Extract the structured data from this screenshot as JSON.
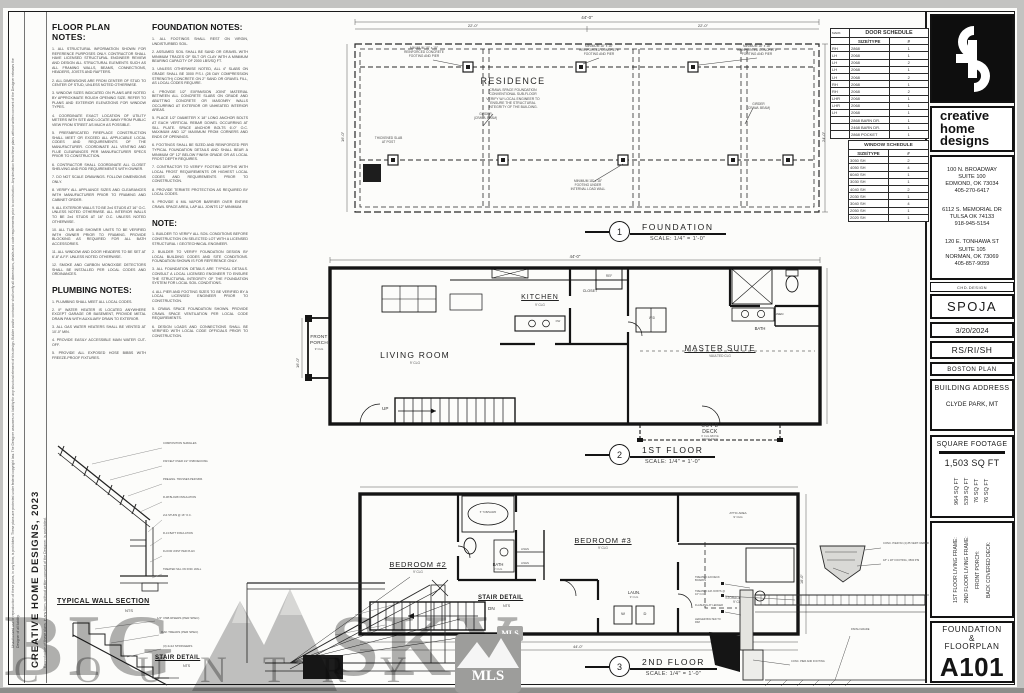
{
  "sheet": {
    "margin_disclaimer": "Unauthorized use or reproduction of these plans, in any form, is prohibited. These plans are protected under federal copyright law. The Designer assumes no liability for any structural element of this design. Builder and/or contractor shall verify all dimensions, details and code requirements prior to construction. Any deviation from these plans without written consent of the Designer releases the Designer of all liability.",
    "side_firm_line": "CREATIVE HOME DESIGNS, 2023",
    "side_sub_line": "Reproduction of these plans, in any form, without written consent of the Designer, is prohibited."
  },
  "notes": {
    "floor_plan": {
      "title": "FLOOR PLAN NOTES:",
      "items": [
        "1. ALL STRUCTURAL INFORMATION SHOWN FOR REFERENCE PURPOSES ONLY. CONTRACTOR SHALL HAVE LICENSED STRUCTURAL ENGINEER REVIEW AND DESIGN ALL STRUCTURAL ELEMENTS SUCH AS ALL FRAMING WALLS, BEAMS, CONNECTIONS, HEADERS, JOISTS AND RAFTERS.",
        "2. ALL DIMENSIONS ARE FROM CENTER OF STUD TO CENTER OF STUD, UNLESS NOTED OTHERWISE.",
        "3. WINDOW SIZES INDICATED ON PLANS ARE NOTED BY APPROXIMATE ROUGH OPENING SIZE. REFER TO PLANS AND EXTERIOR ELEVATIONS FOR WINDOW TYPES.",
        "4. COORDINATE EXACT LOCATION OF UTILITY METERS WITH SITE AND LOCATE AWAY FROM PUBLIC VIEW FROM STREET AS MUCH AS POSSIBLE.",
        "5. PREFABRICATED FIREPLACE CONSTRUCTION SHALL MEET OR EXCEED ALL APPLICABLE LOCAL CODES AND REQUIREMENTS OF THE MANUFACTURER. COORDINATE ALL VENTING AND FLUE CLEARANCES PER MANUFACTURER SPECS PRIOR TO CONSTRUCTION.",
        "6. CONTRACTOR SHALL COORDINATE ALL CLOSET SHELVING AND ROD REQUIREMENTS WITH OWNER.",
        "7. DO NOT SCALE DRAWINGS. FOLLOW DIMENSIONS ONLY.",
        "8. VERIFY ALL APPLIANCE SIZES AND CLEARANCES WITH MANUFACTURER PRIOR TO FRAMING AND CABINET ORDER.",
        "9. ALL EXTERIOR WALLS TO BE 2x4 STUDS AT 16\" O.C. UNLESS NOTED OTHERWISE. ALL INTERIOR WALLS TO BE 2x4 STUDS AT 16\" O.C. UNLESS NOTED OTHERWISE.",
        "10. ALL TUB AND SHOWER UNITS TO BE VERIFIED WITH OWNER PRIOR TO FRAMING. PROVIDE BLOCKING AS REQUIRED FOR ALL BATH ACCESSORIES.",
        "11. ALL WINDOW AND DOOR HEADERS TO BE SET AT 6'-8\" A.F.F. UNLESS NOTED OTHERWISE.",
        "12. SMOKE AND CARBON MONOXIDE DETECTORS SHALL BE INSTALLED PER LOCAL CODES AND ORDINANCES."
      ]
    },
    "plumbing": {
      "title": "PLUMBING NOTES:",
      "items": [
        "1. PLUMBING SHALL MEET ALL LOCAL CODES.",
        "2. IF WATER HEATER IS LOCATED ANYWHERE EXCEPT GARAGE OR BASEMENT, PROVIDE METAL DRAIN PAN WITH AUXILIARY DRAIN TO EXTERIOR.",
        "3. ALL GAS WATER HEATERS SHALL BE VENTED AT 10'-0\" MIN.",
        "4. PROVIDE EASILY ACCESSIBLE MAIN WATER CUT-OFF.",
        "5. PROVIDE ALL EXPOSED HOSE BIBBS WITH FREEZE-PROOF FIXTURES."
      ]
    },
    "foundation": {
      "title": "FOUNDATION NOTES:",
      "items": [
        "1. ALL FOOTINGS SHALL REST ON VIRGIN, UNDISTURBED SOIL.",
        "2. ASSUMED SOIL SHALL BE SAND OR GRAVEL WITH MINIMUM TRACES OF SILT OR CLAY WITH A MINIMUM BEARING CAPACITY OF 2000 LBS/SQ FT.",
        "3. UNLESS OTHERWISE NOTED, ALL 4\" SLABS ON GRADE SHALL BE 3000 P.S.I. (28 DAY COMPRESSION STRENGTH) CONCRETE ON 2\" SAND OR GRAVEL FILL, AS LOCAL CODES REQUIRE.",
        "4. PROVIDE 1/2\" EXPANSION JOINT MATERIAL BETWEEN ALL CONCRETE SLABS ON GRADE AND ABUTTING CONCRETE OR MASONRY WALLS OCCURRING AT EXTERIOR OR UNHEATED INTERIOR AREAS.",
        "5. PLACE 1/2\" DIAMETER X 18\" LONG ANCHOR BOLTS AT EACH VERTICAL REBAR DOWEL OCCURRING AT SILL PLATE. SPACE ANCHOR BOLTS 6'-0\" O.C. MAXIMUM AND 12\" MAXIMUM FROM CORNERS AND ENDS OF OPENINGS.",
        "6. FOOTINGS SHALL BE SIZED AND REINFORCED PER TYPICAL FOUNDATION DETAILS AND SHALL BEAR A MINIMUM OF 12\" BELOW FINISH GRADE OR AS LOCAL FROST DEPTH REQUIRES.",
        "7. CONTRACTOR TO VERIFY FOOTING DEPTHS WITH LOCAL FROST REQUIREMENTS OR HIGHEST LOCAL CODES AND REQUIREMENTS PRIOR TO CONSTRUCTION.",
        "8. PROVIDE TERMITE PROTECTION AS REQUIRED BY LOCAL CODES.",
        "9. PROVIDE 6 MIL VAPOR BARRIER OVER ENTIRE CRAWL SPACE AREA, LAP ALL JOINTS 12\" MINIMUM."
      ]
    },
    "note": {
      "title": "NOTE:",
      "items": [
        "1. BUILDER TO VERIFY ALL SOIL CONDITIONS BEFORE CONSTRUCTION ON SELECTED LOT WITH A LICENSED STRUCTURAL / GEOTECHNICAL ENGINEER.",
        "2. BUILDER TO VERIFY FOUNDATION DESIGN BY LOCAL BUILDING CODES AND SITE CONDITIONS. FOUNDATION SHOWN IS FOR REFERENCE ONLY.",
        "3. ALL FOUNDATION DETAILS ARE TYPICAL DETAILS. CONSULT A LOCAL LICENSED ENGINEER TO ENSURE THE STRUCTURAL INTEGRITY OF THE FOUNDATION SYSTEM FOR LOCAL SOIL CONDITIONS.",
        "4. ALL PIER AND FOOTING SIZES TO BE VERIFIED BY A LOCAL LICENSED ENGINEER PRIOR TO CONSTRUCTION.",
        "5. CRAWL SPACE FOUNDATION SHOWN. PROVIDE CRAWL SPACE VENTILATION PER LOCAL CODE REQUIREMENTS.",
        "6. DESIGN LOADS AND CONNECTIONS SHALL BE VERIFIED WITH LOCAL CODE OFFICIALS PRIOR TO CONSTRUCTION."
      ]
    }
  },
  "details": {
    "wall_section": {
      "title": "TYPICAL WALL SECTION",
      "scale": "NTS",
      "callouts": [
        "COMPOSITION SHINGLES",
        "15# FELT OVER 1/2\" OSB DECKING",
        "PRE-ENG. TRUSSES PER MFR.",
        "R-38 BLOWN INSULATION",
        "2x4 STUDS @ 16\" O.C.",
        "R-13 BATT INSULATION",
        "FLOOR JOIST PER PLAN",
        "TREATED SILL ON FND. WALL"
      ]
    },
    "stair": {
      "title": "STAIR DETAIL",
      "scale": "NTS",
      "callouts": [
        "1/2\" OSB RISERS (PER SPEC)",
        "OAK TREADS (PER SPEC)",
        "(3) 2x12 STRINGERS"
      ]
    },
    "pier": {
      "callouts": [
        "CONC. PIER W/ (4) #5 VERT. REBAR",
        "18\" x 18\" FOOTING, 3500 PSI"
      ]
    },
    "deck": {
      "callouts": [
        "TREATED 2x6 DECK BOARDS",
        "TREATED 2x8 JOISTS @ 16\" O.C.",
        "FLASHING AT LEDGER",
        "LEDGER BOLTED TO RIM",
        "CONC. PIER AND FOOTING",
        "FINISH GRADE"
      ]
    }
  },
  "plans": {
    "foundation": {
      "num": "1",
      "title": "FOUNDATION",
      "scale": "SCALE: 1/4\" = 1'-0\"",
      "residence": "RESIDENCE",
      "residence_notes": "CRAWL SPACE FOUNDATION\nCONVENTIONAL SUB-FLOOR\nVERIFY W/ LOCAL ENGINEER TO\nENSURE THE STRUCTURAL\nINTEGRITY OF THE BUILDING.",
      "pier_callout": "MINIMUM 18\" x 18\"\nREINFORCED CONCRETE\nFOOTING AND PIER",
      "girder_callout": "GIRDER\n(CRAWL BEAM)",
      "slab_callout": "THICKENED SLAB\nAT POST",
      "footing_callout": "MINIMUM 18\" x 18\"\nFOOTING UNDER\nINTERNAL LOAD WALL",
      "dims": {
        "overall": "44'-0\"",
        "seg1": "22'-0\"",
        "seg2": "22'-0\"",
        "right": "24'-0\"",
        "left": "16'-0\""
      }
    },
    "first": {
      "num": "2",
      "title": "1ST FLOOR",
      "scale": "SCALE: 1/4\" = 1'-0\"",
      "rooms": {
        "porch": "FRONT\nPORCH",
        "porch_clg": "9' CLG",
        "living": "LIVING ROOM",
        "living_clg": "9' CLG",
        "kitchen": "KITCHEN",
        "kitchen_clg": "9' CLG",
        "master": "MASTER SUITE",
        "master_clg": "VAULTED CLG",
        "bath": "BATH",
        "closet": "CLOSET",
        "linen": "LINEN",
        "deck": "COV'D\nDECK",
        "deck_clg": "9' CLG ABOVE\nWOOD DECK",
        "up": "UP",
        "ref": "REF",
        "wd": "W/D",
        "dw": "DW"
      },
      "dims": {
        "overall": "44'-0\"",
        "left": "16'-0\"",
        "bottom": "44'-0\""
      }
    },
    "second": {
      "num": "3",
      "title": "2ND FLOOR",
      "scale": "SCALE: 1/4\" = 1'-0\"",
      "rooms": {
        "bed2": "BEDROOM #2",
        "bed2_clg": "9' CLG",
        "bed3": "BEDROOM #3",
        "bed3_clg": "9' CLG",
        "bath": "BATH",
        "bath_clg": "9' CLG",
        "tub": "5' TUB/SHWR",
        "laun": "LAUN.",
        "laun_clg": "9' CLG",
        "linen": "LINEN",
        "dn": "DN",
        "storage": "STORAGE ATTIC\n9' CLG",
        "attic": "ATTIC AREA\n9' CLG",
        "w": "W",
        "d": "D"
      },
      "dims": {
        "bottom": "27'-10\"",
        "overall": "44'-0\"",
        "right": "16'-0\""
      }
    }
  },
  "schedules": {
    "door": {
      "title": "DOOR SCHEDULE",
      "col_mark": "MARK",
      "col_size": "SIZE/TYPE",
      "col_qty": "#",
      "rows": [
        [
          "RH",
          "2868",
          "1"
        ],
        [
          "LH",
          "2068",
          "1"
        ],
        [
          "LH",
          "2068",
          "2"
        ],
        [
          "LH",
          "2068",
          "1"
        ],
        [
          "LH",
          "2068",
          "2"
        ],
        [
          "RH",
          "2068",
          "1"
        ],
        [
          "RH",
          "2068",
          "2"
        ],
        [
          "LHR",
          "2068",
          "1"
        ],
        [
          "LHR",
          "2068",
          "1"
        ],
        [
          "LH",
          "2068",
          "1"
        ],
        [
          "",
          "2868 BARN DR.",
          "1"
        ],
        [
          "",
          "2468 BARN DR.",
          "1"
        ],
        [
          "",
          "2868 POCKET",
          "1"
        ]
      ]
    },
    "window": {
      "title": "WINDOW SCHEDULE",
      "col_size": "SIZE/TYPE",
      "col_qty": "#",
      "rows": [
        [
          "3050 SH",
          "2"
        ],
        [
          "4050 SH",
          "4"
        ],
        [
          "6040 SH",
          "1"
        ],
        [
          "3030 SH",
          "1"
        ],
        [
          "4040 SH",
          "2"
        ],
        [
          "2030 SH",
          "1"
        ],
        [
          "3040 SH",
          "4"
        ],
        [
          "2050 SH",
          "1"
        ],
        [
          "2020 SH",
          "1"
        ]
      ]
    }
  },
  "title_block": {
    "firm_name": "creative\nhome\ndesigns",
    "addresses": [
      "100 N. BROADWAY\nSUITE 100\nEDMOND, OK 73034\n405-270-6417",
      "6112 S. MEMORIAL DR\nTULSA OK 74133\n918-945-5154",
      "120 E. TONHAWA ST\nSUITE 105\nNORMAN, OK 73069\n405-857-9059"
    ],
    "website": "CHD.DESIGN",
    "client": "SPOJA",
    "date": "3/20/2024",
    "permit": "RS/RI/SH",
    "plan_name": "BOSTON PLAN",
    "address_label": "BUILDING ADDRESS",
    "address_value": "CLYDE PARK, MT",
    "sqft_label": "SQUARE FOOTAGE",
    "sqft_total": "1,503 SQ FT",
    "sqft_values": [
      "964 SQ FT",
      "539 SQ FT",
      "76 SQ FT",
      "76 SQ FT"
    ],
    "sqft_labels": [
      "1ST FLOOR LIVING FRAME:",
      "2ND FLOOR LIVING FRAME:",
      "FRONT PORCH:",
      "BACK COVERED DECK:"
    ],
    "sheet_title": "FOUNDATION\n&\nFLOORPLAN",
    "sheet_number": "A101"
  },
  "watermark": {
    "big": "BIG",
    "sky": "SKY",
    "country": "COUNTRY",
    "mls": "MLS"
  }
}
